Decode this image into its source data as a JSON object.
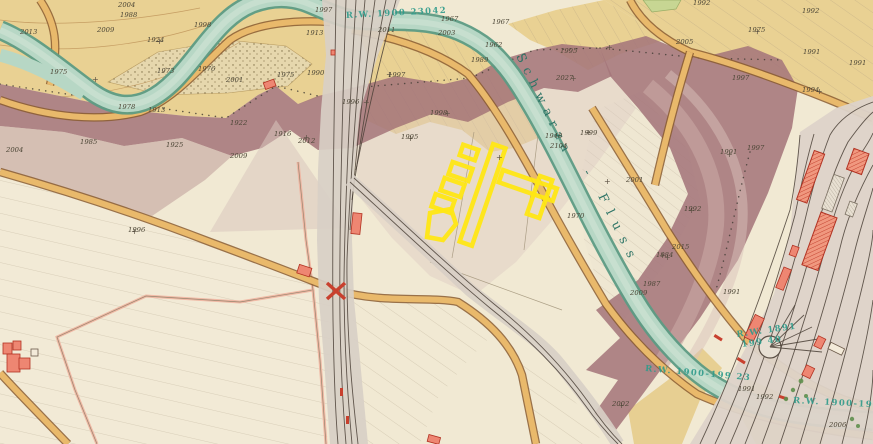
{
  "map": {
    "type": "historical-cadastral-map",
    "river_label": {
      "part1": "Schwarza",
      "separator": "-",
      "part2": "Fluss"
    },
    "survey_marks": [
      {
        "text": "R.W. 1900 23042",
        "x": 346,
        "y": 18,
        "rot": -3
      },
      {
        "text": "R.W. 1891",
        "x": 737,
        "y": 337,
        "rot": -8
      },
      {
        "text": "199 40",
        "x": 742,
        "y": 347,
        "rot": -8
      },
      {
        "text": "R.W. 1900-199 23",
        "x": 645,
        "y": 371,
        "rot": 5
      },
      {
        "text": "R.W. 1900-1991",
        "x": 793,
        "y": 403,
        "rot": 3
      }
    ],
    "elevation_numbers": [
      {
        "t": "2004",
        "x": 118,
        "y": 7
      },
      {
        "t": "1988",
        "x": 120,
        "y": 17
      },
      {
        "t": "2009",
        "x": 97,
        "y": 32
      },
      {
        "t": "1998",
        "x": 194,
        "y": 27
      },
      {
        "t": "2013",
        "x": 20,
        "y": 34
      },
      {
        "t": "1924",
        "x": 147,
        "y": 42
      },
      {
        "t": "1973",
        "x": 157,
        "y": 73
      },
      {
        "t": "1975",
        "x": 50,
        "y": 74
      },
      {
        "t": "1976",
        "x": 198,
        "y": 71
      },
      {
        "t": "2001",
        "x": 226,
        "y": 82
      },
      {
        "t": "1978",
        "x": 118,
        "y": 109
      },
      {
        "t": "1913",
        "x": 148,
        "y": 112
      },
      {
        "t": "1985",
        "x": 80,
        "y": 144
      },
      {
        "t": "1925",
        "x": 166,
        "y": 147
      },
      {
        "t": "2004",
        "x": 6,
        "y": 152
      },
      {
        "t": "1922",
        "x": 230,
        "y": 125
      },
      {
        "t": "1916",
        "x": 274,
        "y": 136
      },
      {
        "t": "2012",
        "x": 298,
        "y": 143
      },
      {
        "t": "2009",
        "x": 230,
        "y": 158
      },
      {
        "t": "1996",
        "x": 128,
        "y": 232
      },
      {
        "t": "1997",
        "x": 315,
        "y": 12
      },
      {
        "t": "1913",
        "x": 306,
        "y": 35
      },
      {
        "t": "2011",
        "x": 378,
        "y": 32
      },
      {
        "t": "2003",
        "x": 438,
        "y": 35
      },
      {
        "t": "1967",
        "x": 492,
        "y": 24
      },
      {
        "t": "1990",
        "x": 307,
        "y": 75
      },
      {
        "t": "1975",
        "x": 277,
        "y": 77
      },
      {
        "t": "1997",
        "x": 388,
        "y": 77
      },
      {
        "t": "1996",
        "x": 342,
        "y": 104
      },
      {
        "t": "1998",
        "x": 430,
        "y": 115
      },
      {
        "t": "1995",
        "x": 401,
        "y": 139
      },
      {
        "t": "1967",
        "x": 441,
        "y": 21
      },
      {
        "t": "1962",
        "x": 485,
        "y": 47
      },
      {
        "t": "1989",
        "x": 471,
        "y": 62
      },
      {
        "t": "1995",
        "x": 560,
        "y": 53
      },
      {
        "t": "2027",
        "x": 556,
        "y": 80
      },
      {
        "t": "1948",
        "x": 545,
        "y": 138
      },
      {
        "t": "2104",
        "x": 550,
        "y": 148
      },
      {
        "t": "1999",
        "x": 580,
        "y": 135
      },
      {
        "t": "2001",
        "x": 626,
        "y": 182
      },
      {
        "t": "1970",
        "x": 567,
        "y": 218
      },
      {
        "t": "2015",
        "x": 672,
        "y": 249
      },
      {
        "t": "1984",
        "x": 656,
        "y": 257
      },
      {
        "t": "1987",
        "x": 643,
        "y": 286
      },
      {
        "t": "2009",
        "x": 630,
        "y": 295
      },
      {
        "t": "1992",
        "x": 684,
        "y": 211
      },
      {
        "t": "1991",
        "x": 720,
        "y": 154
      },
      {
        "t": "1992",
        "x": 693,
        "y": 5
      },
      {
        "t": "2005",
        "x": 676,
        "y": 44
      },
      {
        "t": "1975",
        "x": 748,
        "y": 32
      },
      {
        "t": "1991",
        "x": 803,
        "y": 54
      },
      {
        "t": "1997",
        "x": 732,
        "y": 80
      },
      {
        "t": "1994",
        "x": 802,
        "y": 92
      },
      {
        "t": "1992",
        "x": 802,
        "y": 13
      },
      {
        "t": "1991",
        "x": 849,
        "y": 65
      },
      {
        "t": "1997",
        "x": 747,
        "y": 150
      },
      {
        "t": "2002",
        "x": 612,
        "y": 406
      },
      {
        "t": "1991",
        "x": 723,
        "y": 294
      },
      {
        "t": "1991",
        "x": 738,
        "y": 391
      },
      {
        "t": "1992",
        "x": 756,
        "y": 399
      },
      {
        "t": "2006",
        "x": 829,
        "y": 427
      }
    ],
    "survey_crosses": [
      [
        386,
        77
      ],
      [
        570,
        81
      ],
      [
        444,
        116
      ],
      [
        407,
        141
      ],
      [
        688,
        213
      ],
      [
        726,
        157
      ],
      [
        604,
        184
      ],
      [
        659,
        258
      ],
      [
        131,
        234
      ],
      [
        92,
        82
      ],
      [
        156,
        44
      ],
      [
        606,
        50
      ],
      [
        816,
        94
      ],
      [
        754,
        34
      ],
      [
        496,
        160
      ],
      [
        664,
        260
      ],
      [
        618,
        408
      ],
      [
        363,
        105
      ],
      [
        303,
        140
      ],
      [
        585,
        135
      ]
    ],
    "colors": {
      "paper": "#f1e9d3",
      "field_tan": "#e9d193",
      "river_fill": "#b7d7c5",
      "river_edge": "#5c9b84",
      "road_fill": "#e9b96b",
      "road_edge": "#8a5c30",
      "railway_grey": "#d8cfc6",
      "track_ink": "#4a4036",
      "flood_band": "#a5767b",
      "flood_band_light": "#c3a39f",
      "building_red": "#ee8672",
      "building_red_edge": "#b23222",
      "highlight_yellow": "#ffe714",
      "survey_teal": "#2e9b8b",
      "number_ink": "#4c4636",
      "gravel_dot": "#7d6c45",
      "tree_green": "#5e8f4e"
    }
  }
}
